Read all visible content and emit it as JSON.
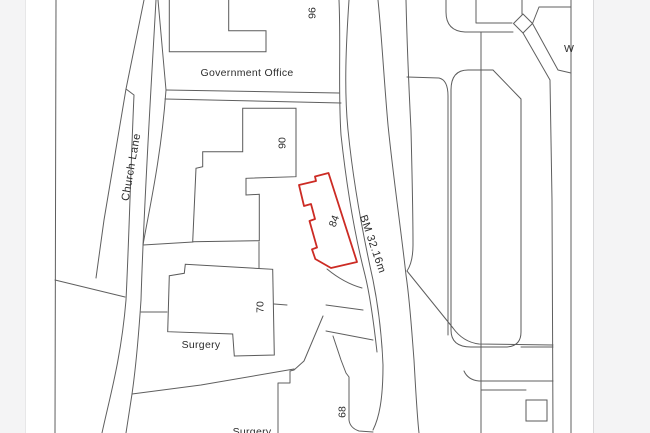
{
  "colors": {
    "page_margin_bg": "#f4f4f5",
    "map_background": "#ffffff",
    "map_line": "#5f5f5f",
    "map_text": "#2d2d2d",
    "plot_red": "#cc2b24"
  },
  "map": {
    "labels": {
      "government_office": "Government Office",
      "church_lane": "Church Lane",
      "benchmark": "BM 32.16m",
      "surgery_upper": "Surgery",
      "surgery_lower": "Surgery",
      "house_96": "96",
      "house_90": "90",
      "house_84": "84",
      "house_70": "70",
      "house_68": "68",
      "w_partial": "W"
    }
  }
}
